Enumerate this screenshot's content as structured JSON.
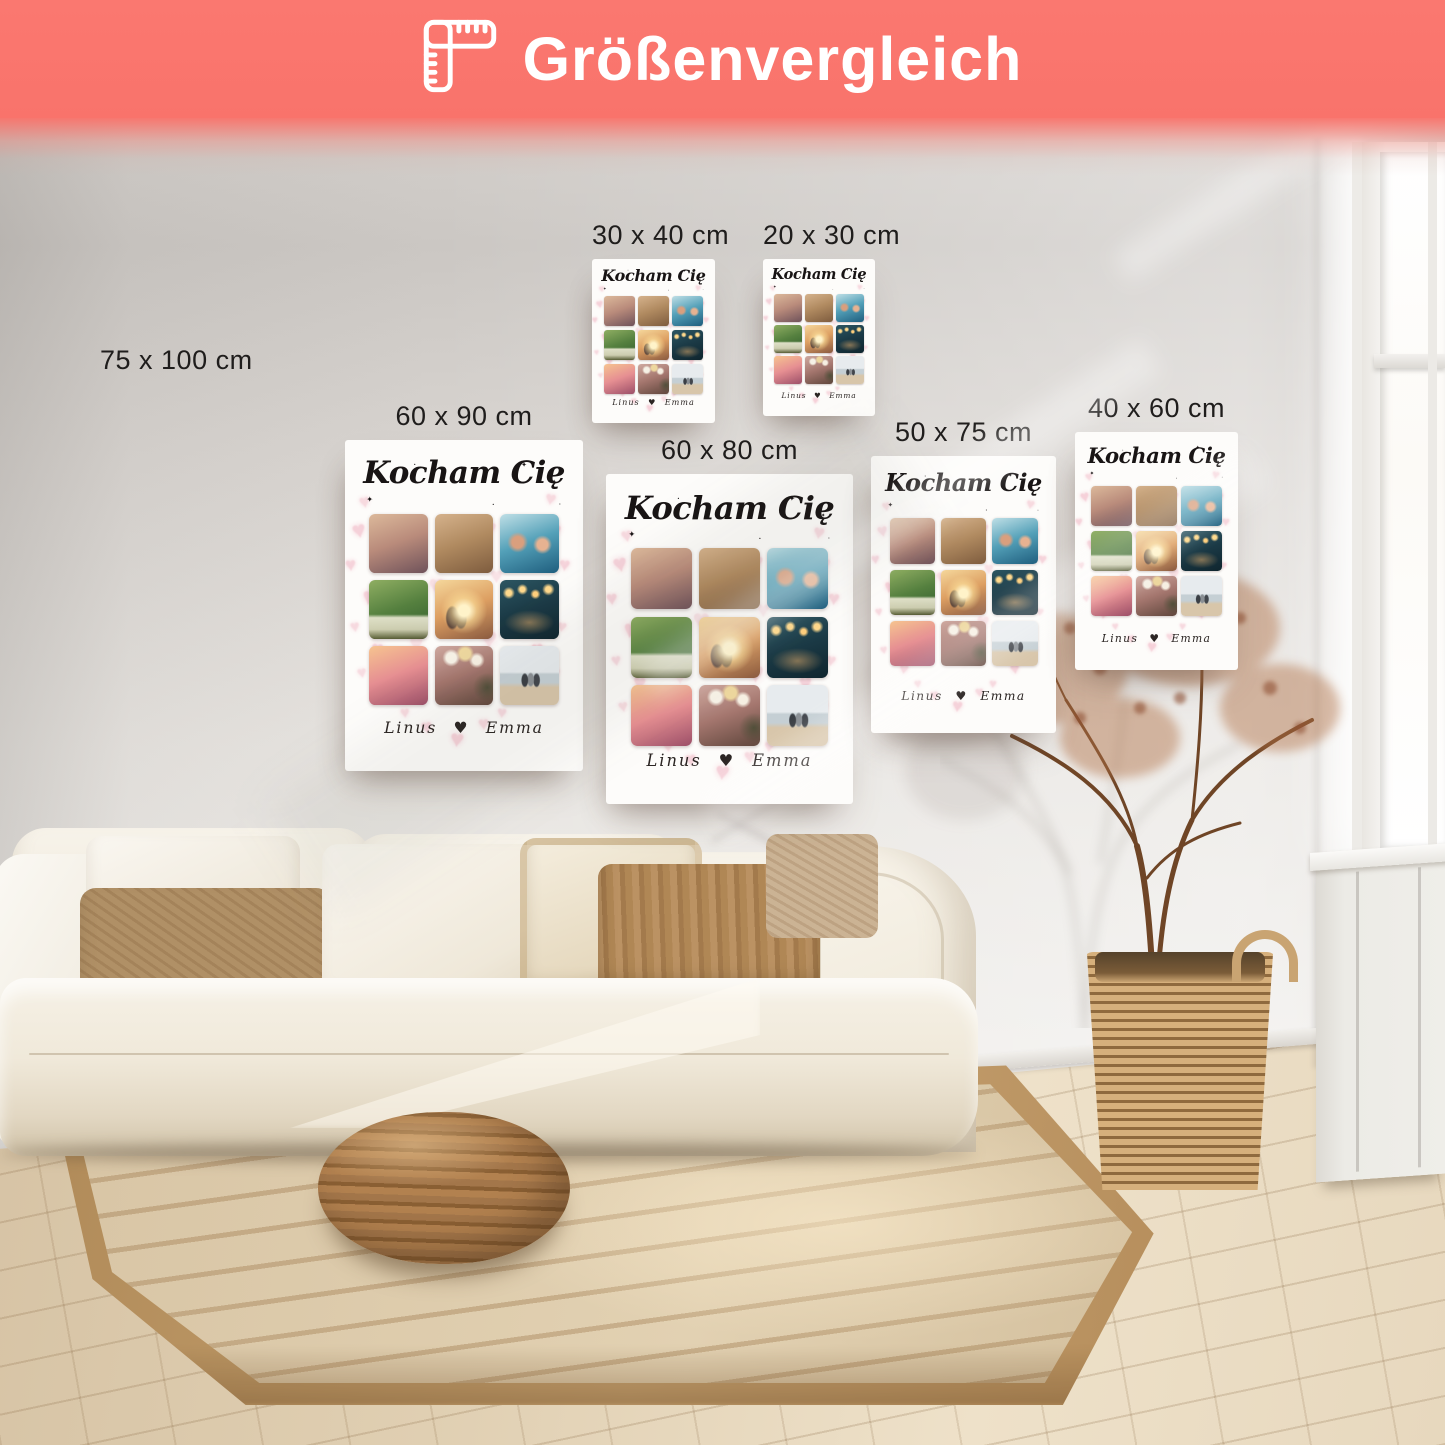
{
  "header": {
    "title": "Größenvergleich",
    "background_color": "#f9736b",
    "text_color": "#ffffff",
    "icon": "ruler-icon"
  },
  "sizes": [
    {
      "label": "75 x 100 cm",
      "has_poster": false
    },
    {
      "label": "30 x 40 cm",
      "has_poster": true
    },
    {
      "label": "20 x 30 cm",
      "has_poster": true
    },
    {
      "label": "60 x 90 cm",
      "has_poster": true
    },
    {
      "label": "60 x 80 cm",
      "has_poster": true
    },
    {
      "label": "50 x 75 cm",
      "has_poster": true
    },
    {
      "label": "40 x 60 cm",
      "has_poster": true
    }
  ],
  "poster_design": {
    "title": "Kocham Cię",
    "couple_names": "Linus ♥ Emma",
    "heart_glyph": "♥",
    "sparkle_glyph": "✦",
    "dot_glyph": "•",
    "background_color": "#fdfcfa",
    "heart_color": "#f3c3ce",
    "title_color": "#181414",
    "names_color": "#2b2523",
    "photos": [
      {
        "name": "friends-cheering-photo",
        "type": "plain",
        "colors": [
          "#dcb99b",
          "#b98b7b",
          "#6f525a"
        ]
      },
      {
        "name": "elephant-walk-photo",
        "type": "plain",
        "colors": [
          "#d5b28c",
          "#b08a60",
          "#7e5c3e"
        ]
      },
      {
        "name": "pool-party-photo",
        "type": "pool",
        "colors": [
          "#bfdfe6",
          "#53a0b8",
          "#1f5e7e"
        ]
      },
      {
        "name": "garden-dinner-photo",
        "type": "garden",
        "colors": [
          "#8fae62",
          "#55803f",
          "#2f5a2c"
        ]
      },
      {
        "name": "sunset-couple-photo",
        "type": "sun",
        "colors": [
          "#f5d79b",
          "#dd9f62",
          "#8a5a40"
        ]
      },
      {
        "name": "sparkler-night-photo",
        "type": "lights",
        "colors": [
          "#2c5662",
          "#1b3a46",
          "#0f252e"
        ]
      },
      {
        "name": "sunset-beach-dance-photo",
        "type": "plain",
        "colors": [
          "#f6c490",
          "#e68f92",
          "#9c4f68"
        ]
      },
      {
        "name": "party-balloons-photo",
        "type": "balloons",
        "colors": [
          "#cfa9a0",
          "#a4766e",
          "#5f463c"
        ]
      },
      {
        "name": "family-beach-photo",
        "type": "beach",
        "colors": [
          "#e7ebee",
          "#c5cfd4",
          "#d8c6aa"
        ]
      }
    ]
  },
  "scene": {
    "wall_color": "#e7e4e0",
    "floor_color": "#e0cfb2",
    "rug_color": "#d8c5a5",
    "sofa_color": "#f3eee2",
    "pillow_brown": "#a37a4c",
    "pouf_color": "#a3764a",
    "basket_color": "#c9a472",
    "plant_color": "#9c5c38",
    "window_light": "#ffffff"
  }
}
